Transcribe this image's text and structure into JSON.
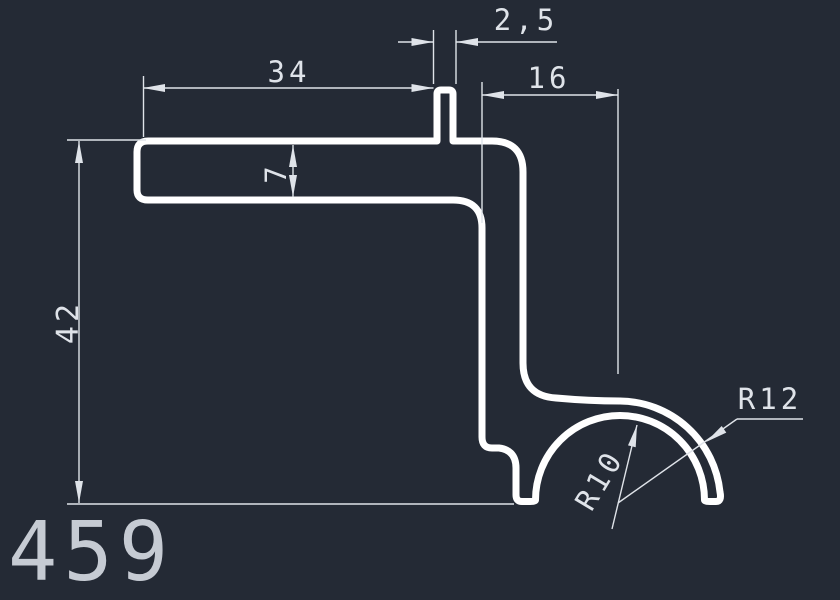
{
  "canvas": {
    "background": "#242a35",
    "profile_color": "#ffffff",
    "dimension_color": "#dfe3e9",
    "part_number_color": "#c6cbd3"
  },
  "drawing": {
    "part_number": "459",
    "dimensions": {
      "flange_width": "34",
      "tab_width": "2,5",
      "right_offset": "16",
      "flange_thickness": "7",
      "overall_height": "42",
      "inner_radius": "R10",
      "outer_radius": "R12"
    }
  }
}
